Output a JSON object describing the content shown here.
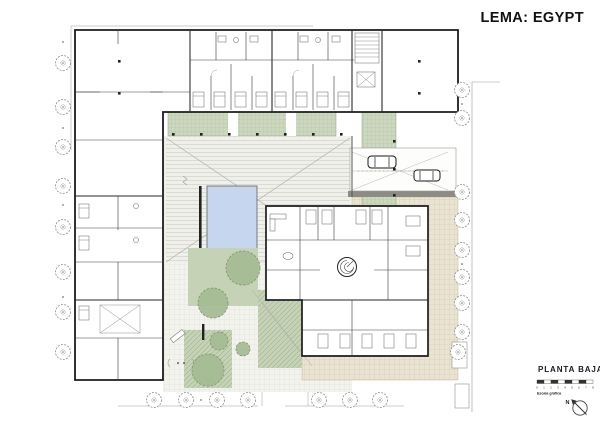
{
  "title": "LEMA: EGYPT",
  "legend": {
    "plan_name": "PLANTA BAJA",
    "scale_caption": "Escala gráfica",
    "scale_ticks": [
      "0",
      "1",
      "2",
      "3",
      "4",
      "5",
      "6",
      "7",
      "8"
    ],
    "north_label": "N"
  },
  "colors": {
    "wall": "#1c1c1c",
    "planting_green": "#ccd7bf",
    "lawn_green": "#c6d2b6",
    "tree_green": "#a4bb92",
    "pool_blue": "#c7d6ef",
    "paving_gray": "#f3f3ee",
    "plaza_tan": "#eae3d2",
    "band_gray": "#8c8c85"
  },
  "plan": {
    "drawing": "ground-floor site plan",
    "street_trees_left": 8,
    "street_trees_right": 9,
    "street_trees_bottom": 7,
    "courtyard_trees": 5,
    "cars": 2
  }
}
